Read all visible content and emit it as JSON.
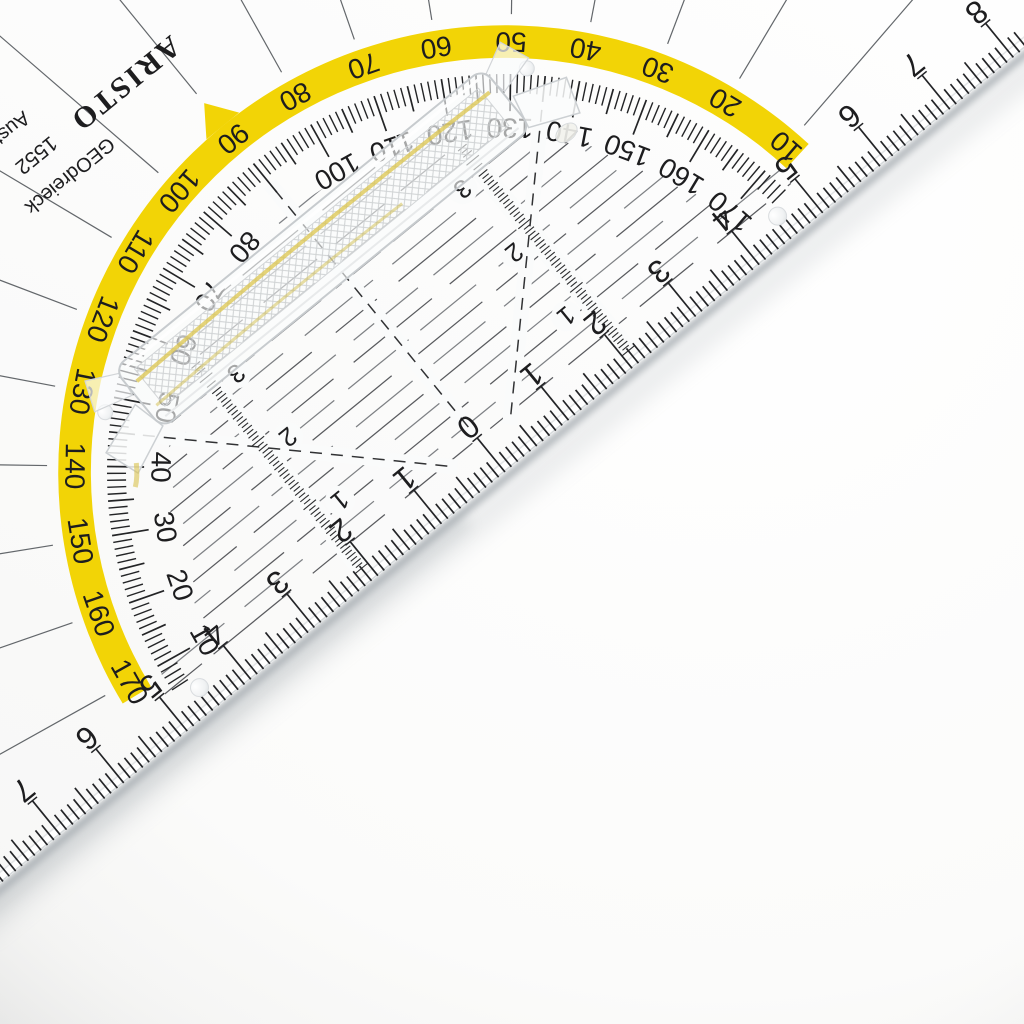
{
  "scene": {
    "description": "Close-up photo of a transparent ARISTO geometry set square (Geodreieck) with removable handle, lying diagonally on a white surface"
  },
  "brand": {
    "logo": "ARISTO",
    "sub_lines": [
      "GEOdreieck",
      "1552",
      "Austria"
    ]
  },
  "colors": {
    "band_yellow": "#F2D406",
    "print": "#1D1D1F",
    "ring_tick": "#232426",
    "row_line_dark": "#47494D",
    "row_line_light": "#717478",
    "radial_gray": "#63676B",
    "plastic_outline": "#C7CBCE",
    "handle_yellow": "#DCC54D",
    "shadow": "#9AA1A7",
    "background": "#F5F5F4"
  },
  "protractor": {
    "outer_degree_labels": [
      10,
      20,
      30,
      40,
      50,
      60,
      70,
      80,
      90,
      100,
      110,
      120,
      130,
      140,
      150,
      160,
      170
    ],
    "inner_degree_labels": [
      170,
      160,
      150,
      140,
      130,
      120,
      110,
      100,
      80,
      70,
      60,
      50,
      40,
      30,
      20,
      10
    ],
    "tick_step_deg": 1,
    "label_step_deg": 10
  },
  "hypotenuse_scale": {
    "zero_label": "0",
    "right_labels": [
      1,
      2,
      3,
      4,
      5,
      6,
      7,
      8
    ],
    "left_labels": [
      1,
      2,
      3,
      4,
      5,
      6,
      7
    ]
  },
  "parallel_scales": {
    "right_labels": [
      1,
      2,
      3
    ],
    "left_labels": [
      1,
      2,
      3
    ]
  }
}
